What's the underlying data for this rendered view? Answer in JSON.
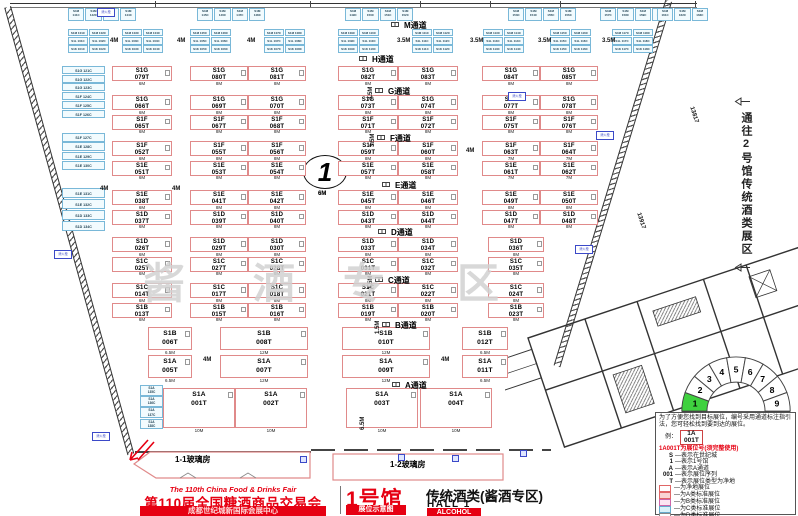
{
  "colors": {
    "accent_red": "#e60012",
    "booth_pink_border": "#e08a8a",
    "booth_blue_border": "#79b8d8",
    "hall_green": "#3fd13f"
  },
  "title_block": {
    "en": "The 110th China Food & Drinks Fair",
    "cn": "第110届全国糖酒商品交易会",
    "venue": "成都世纪城新国际会展中心",
    "hall_cn": "1号馆",
    "map_badge": "展位示意图",
    "hall_sub": "传统酒类(酱酒专区)",
    "hall_en": "HALL 1",
    "hall_type": "ALCOHOL"
  },
  "right_note": {
    "text": "通往2号馆传统酒类展区"
  },
  "circle_marker": {
    "number": "1",
    "dim_below": "6M"
  },
  "watermark": {
    "chars": [
      "酱",
      "酒",
      "专",
      "区"
    ]
  },
  "wall_tag_text": "消火栓",
  "dimension_texts": [
    "4M",
    "4M",
    "4M",
    "3.5M",
    "3.5M",
    "3.5M",
    "3.5M",
    "4M",
    "4M",
    "4M",
    "4M",
    "4M",
    "6M",
    "6.5M",
    "13817",
    "13917"
  ],
  "aisles": [
    {
      "label": "M通道",
      "dim": ""
    },
    {
      "label": "H通道",
      "dim": ""
    },
    {
      "label": "G通道",
      "dim": "3.5M"
    },
    {
      "label": "F通道",
      "dim": "3.5M"
    },
    {
      "label": "E通道",
      "dim": ""
    },
    {
      "label": "D通道",
      "dim": ""
    },
    {
      "label": "C通道",
      "dim": "1.5M"
    },
    {
      "label": "B通道",
      "dim": "1.5M"
    },
    {
      "label": "A通道",
      "dim": ""
    }
  ],
  "glass_houses": {
    "g1": "1-1玻璃房",
    "g2": "1-2玻璃房"
  },
  "floor": {
    "bands": [
      {
        "name": "H",
        "rows": [
          [
            {
              "c": "S1G 079T",
              "s": "6M"
            },
            {
              "c": "S1G 080T",
              "s": "8M"
            },
            {
              "c": "S1G 081T",
              "s": "8M"
            },
            {
              "c": "S1G 082T",
              "s": "8M"
            },
            {
              "c": "S1G 083T",
              "s": "8M"
            },
            {
              "c": "S1G 084T",
              "s": "8M"
            },
            {
              "c": "S1G 085T",
              "s": "8M"
            }
          ]
        ]
      },
      {
        "name": "G-F",
        "rows": [
          [
            {
              "c": "S1G 066T",
              "s": "6M"
            },
            {
              "c": "S1G 069T",
              "s": "8M"
            },
            {
              "c": "S1G 070T",
              "s": "8M"
            },
            {
              "c": "S1G 073T",
              "s": "8M"
            },
            {
              "c": "S1G 074T",
              "s": "8M"
            },
            {
              "c": "S1G 077T",
              "s": "8M"
            },
            {
              "c": "S1G 078T",
              "s": "8M"
            }
          ],
          [
            {
              "c": "S1F 065T",
              "s": "6M"
            },
            {
              "c": "S1F 067T",
              "s": "8M"
            },
            {
              "c": "S1F 068T",
              "s": "8M"
            },
            {
              "c": "S1F 071T",
              "s": "8M"
            },
            {
              "c": "S1F 072T",
              "s": "8M"
            },
            {
              "c": "S1F 075T",
              "s": "8M"
            },
            {
              "c": "S1F 076T",
              "s": "8M"
            }
          ]
        ]
      },
      {
        "name": "F-E",
        "rows": [
          [
            {
              "c": "S1F 052T",
              "s": "6M"
            },
            {
              "c": "S1F 055T",
              "s": "8M"
            },
            {
              "c": "S1F 056T",
              "s": "8M"
            },
            {
              "c": "S1F 059T",
              "s": "8M"
            },
            {
              "c": "S1F 060T",
              "s": "8M"
            },
            {
              "c": "S1F 063T",
              "s": "7M"
            },
            {
              "c": "S1F 064T",
              "s": "7M"
            }
          ],
          [
            {
              "c": "S1E 051T",
              "s": "6M"
            },
            {
              "c": "S1E 053T",
              "s": "8M"
            },
            {
              "c": "S1E 054T",
              "s": "8M"
            },
            {
              "c": "S1E 057T",
              "s": "8M"
            },
            {
              "c": "S1E 058T",
              "s": "8M"
            },
            {
              "c": "S1E 061T",
              "s": "7M"
            },
            {
              "c": "S1E 062T",
              "s": "7M"
            }
          ]
        ]
      },
      {
        "name": "E-D",
        "rows": [
          [
            {
              "c": "S1E 038T",
              "s": "6M"
            },
            {
              "c": "S1E 041T",
              "s": "8M"
            },
            {
              "c": "S1E 042T",
              "s": "8M"
            },
            {
              "c": "S1E 045T",
              "s": "8M"
            },
            {
              "c": "S1E 046T",
              "s": "8M"
            },
            {
              "c": "S1E 049T",
              "s": "8M"
            },
            {
              "c": "S1E 050T",
              "s": "8M"
            }
          ],
          [
            {
              "c": "S1D 037T",
              "s": "6M"
            },
            {
              "c": "S1D 039T",
              "s": "8M"
            },
            {
              "c": "S1D 040T",
              "s": "8M"
            },
            {
              "c": "S1D 043T",
              "s": "8M"
            },
            {
              "c": "S1D 044T",
              "s": "8M"
            },
            {
              "c": "S1D 047T",
              "s": "8M"
            },
            {
              "c": "S1D 048T",
              "s": "8M"
            }
          ]
        ]
      },
      {
        "name": "D-C",
        "rows": [
          [
            {
              "c": "S1D 026T",
              "s": "6M"
            },
            {
              "c": "S1D 029T",
              "s": "8M"
            },
            {
              "c": "S1D 030T",
              "s": "8M"
            },
            {
              "c": "S1D 033T",
              "s": "8M"
            },
            {
              "c": "S1D 034T",
              "s": "8M"
            },
            {
              "c": "S1D 036T",
              "s": "8M"
            }
          ],
          [
            {
              "c": "S1C 025T",
              "s": "6M"
            },
            {
              "c": "S1C 027T",
              "s": "8M"
            },
            {
              "c": "S1C 028T",
              "s": "8M"
            },
            {
              "c": "S1C 031T",
              "s": "8M"
            },
            {
              "c": "S1C 032T",
              "s": "8M"
            },
            {
              "c": "S1C 035T",
              "s": "8M"
            }
          ]
        ]
      },
      {
        "name": "C-B",
        "rows": [
          [
            {
              "c": "S1C 014T",
              "s": "6M"
            },
            {
              "c": "S1C 017T",
              "s": "8M"
            },
            {
              "c": "S1C 018T",
              "s": "8M"
            },
            {
              "c": "S1C 021T",
              "s": "8M"
            },
            {
              "c": "S1C 022T",
              "s": "8M"
            },
            {
              "c": "S1C 024T",
              "s": "8M"
            }
          ],
          [
            {
              "c": "S1B 013T",
              "s": "6M"
            },
            {
              "c": "S1B 015T",
              "s": "8M"
            },
            {
              "c": "S1B 016T",
              "s": "8M"
            },
            {
              "c": "S1B 019T",
              "s": "8M"
            },
            {
              "c": "S1B 020T",
              "s": "8M"
            },
            {
              "c": "S1B 023T",
              "s": "8M"
            }
          ]
        ]
      },
      {
        "name": "B-A",
        "rows": [
          [
            {
              "c": "S1B 006T",
              "s": "6.5M"
            },
            {
              "c": "S1B 008T",
              "s": "12M"
            },
            {
              "c": "S1B 010T",
              "s": "12M"
            },
            {
              "c": "S1B 012T",
              "s": "6.5M"
            }
          ],
          [
            {
              "c": "S1A 005T",
              "s": "6.5M"
            },
            {
              "c": "S1A 007T",
              "s": "12M"
            },
            {
              "c": "S1A 009T",
              "s": "12M"
            },
            {
              "c": "S1A 011T",
              "s": "6.5M"
            }
          ]
        ]
      },
      {
        "name": "A",
        "rows": [
          [
            {
              "c": "S1A 001T",
              "s": "10M"
            },
            {
              "c": "S1A 002T",
              "s": "10M"
            },
            {
              "c": "S1A 003T",
              "s": "10M"
            },
            {
              "c": "S1A 004T",
              "s": "10M"
            }
          ]
        ]
      }
    ],
    "blue_top": [
      "S1M 141C",
      "S1M 142C",
      "S1M 143C",
      "S1M 144C",
      "S1M 145C",
      "S1M 146C",
      "S1M 147C",
      "S1M 148C",
      "S1M 149C",
      "S1M 150C",
      "S1M 151C",
      "S1M 152C",
      "S1M 153C",
      "S1M 154C",
      "S1M 155C",
      "S1M 156C",
      "S1M 157C",
      "S1M 158C",
      "S1M 159C",
      "S1M 160C",
      "S1M 161C",
      "S1M 162C",
      "S1M 163C"
    ],
    "blue_mid_groups": [
      [
        "S1M 101C",
        "S1M 102C",
        "S1L 101C",
        "S1L 102C",
        "S1K 101C",
        "S1K 102C"
      ],
      [
        "S1M 103C",
        "S1M 104C",
        "S1L 103C",
        "S1L 104C",
        "S1K 103C",
        "S1K 104C"
      ],
      [
        "S1M 105C",
        "S1M 106C",
        "S1L 105C",
        "S1L 106C",
        "S1K 105C",
        "S1K 106C"
      ],
      [
        "S1M 107C",
        "S1M 108C",
        "S1L 107C",
        "S1L 108C",
        "S1K 107C",
        "S1K 108C"
      ],
      [
        "S1M 109C",
        "S1M 110C",
        "S1L 109C",
        "S1L 110C",
        "S1K 109C",
        "S1K 110C"
      ],
      [
        "S1M 111C",
        "S1M 112C",
        "S1L 111C",
        "S1L 112C",
        "S1K 111C",
        "S1K 112C"
      ],
      [
        "S1M 113C",
        "S1M 114C",
        "S1L 113C",
        "S1L 114C",
        "S1K 113C",
        "S1K 114C"
      ],
      [
        "S1M 115C",
        "S1M 116C",
        "S1L 115C",
        "S1L 116C",
        "S1K 115C",
        "S1K 116C"
      ],
      [
        "S1M 117C",
        "S1M 118C",
        "S1L 117C",
        "S1L 118C",
        "S1K 117C",
        "S1K 118C"
      ]
    ],
    "blue_left_groups": [
      [
        "S1G 121C",
        "S1G 122C",
        "S1G 123C",
        "S1F 124C",
        "S1F 125C",
        "S1F 126C"
      ],
      [
        "S1F 127C",
        "S1E 128C",
        "S1E 129C",
        "S1E 130C"
      ],
      [
        "S1E 131C",
        "S1E 132C",
        "S1D 133C",
        "S1D 134C"
      ]
    ],
    "blue_bottom_left": [
      "S1A 135C",
      "S1A 136C",
      "S1A 137C",
      "S1A 138C"
    ]
  },
  "hall_map": {
    "numbers": [
      "1",
      "2",
      "3",
      "4",
      "5",
      "6",
      "7",
      "8",
      "9"
    ],
    "highlight": "1"
  },
  "legend": {
    "intro": "为了方便您找到目标展位，编号采用通道标注指引法，您可轻松找到要到达的展位。",
    "example_label": "例：",
    "example_top": "1A",
    "example_bottom": "001T",
    "code_note": "1A001T为展位号(须完整使用)",
    "keys": [
      {
        "k": "S",
        "v": "—表示在世纪城"
      },
      {
        "k": "1",
        "v": "—表示1号馆"
      },
      {
        "k": "A",
        "v": "—表示A通道"
      },
      {
        "k": "001",
        "v": "—表示展位序列"
      },
      {
        "k": "T",
        "v": "—表示展位类型为净地"
      }
    ],
    "swatches": [
      {
        "label": "—为净地展位",
        "fill": "#ffffff",
        "border": "#e06666"
      },
      {
        "label": "—为A类标准展位",
        "fill": "#f9d5d3",
        "border": "#e06666"
      },
      {
        "label": "—为B类标准展位",
        "fill": "#fce5f2",
        "border": "#cc66aa"
      },
      {
        "label": "—为C类标准展位",
        "fill": "#d9f2f9",
        "border": "#66aacc"
      },
      {
        "label": "—为D类标准展位",
        "fill": "#ffffff",
        "border": "#888888"
      }
    ],
    "fire_note": "消防设施严禁遮挡"
  }
}
